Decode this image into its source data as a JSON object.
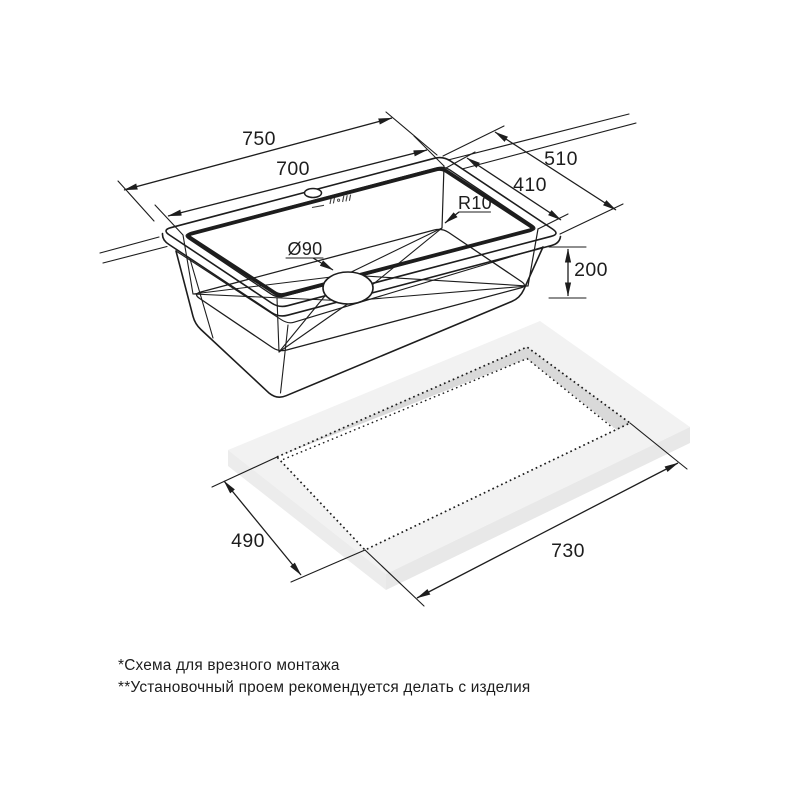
{
  "drawing": {
    "sink": {
      "outer_width": "750",
      "bowl_width": "700",
      "outer_depth": "510",
      "bowl_depth": "410",
      "corner_radius": "R10",
      "drain_diameter": "Ø90",
      "bowl_height": "200"
    },
    "cutout": {
      "depth": "490",
      "width": "730"
    }
  },
  "footnotes": {
    "line1": "*Схема для врезного монтажа",
    "line2": "**Установочный проем рекомендуется делать с изделия"
  },
  "colors": {
    "line": "#1d1d1d",
    "background": "#ffffff",
    "slab_top": "#f2f2f2",
    "slab_front_left": "#ececec",
    "slab_front_right": "#e8e8e8",
    "cutout_wall": "#d9d9d9"
  }
}
